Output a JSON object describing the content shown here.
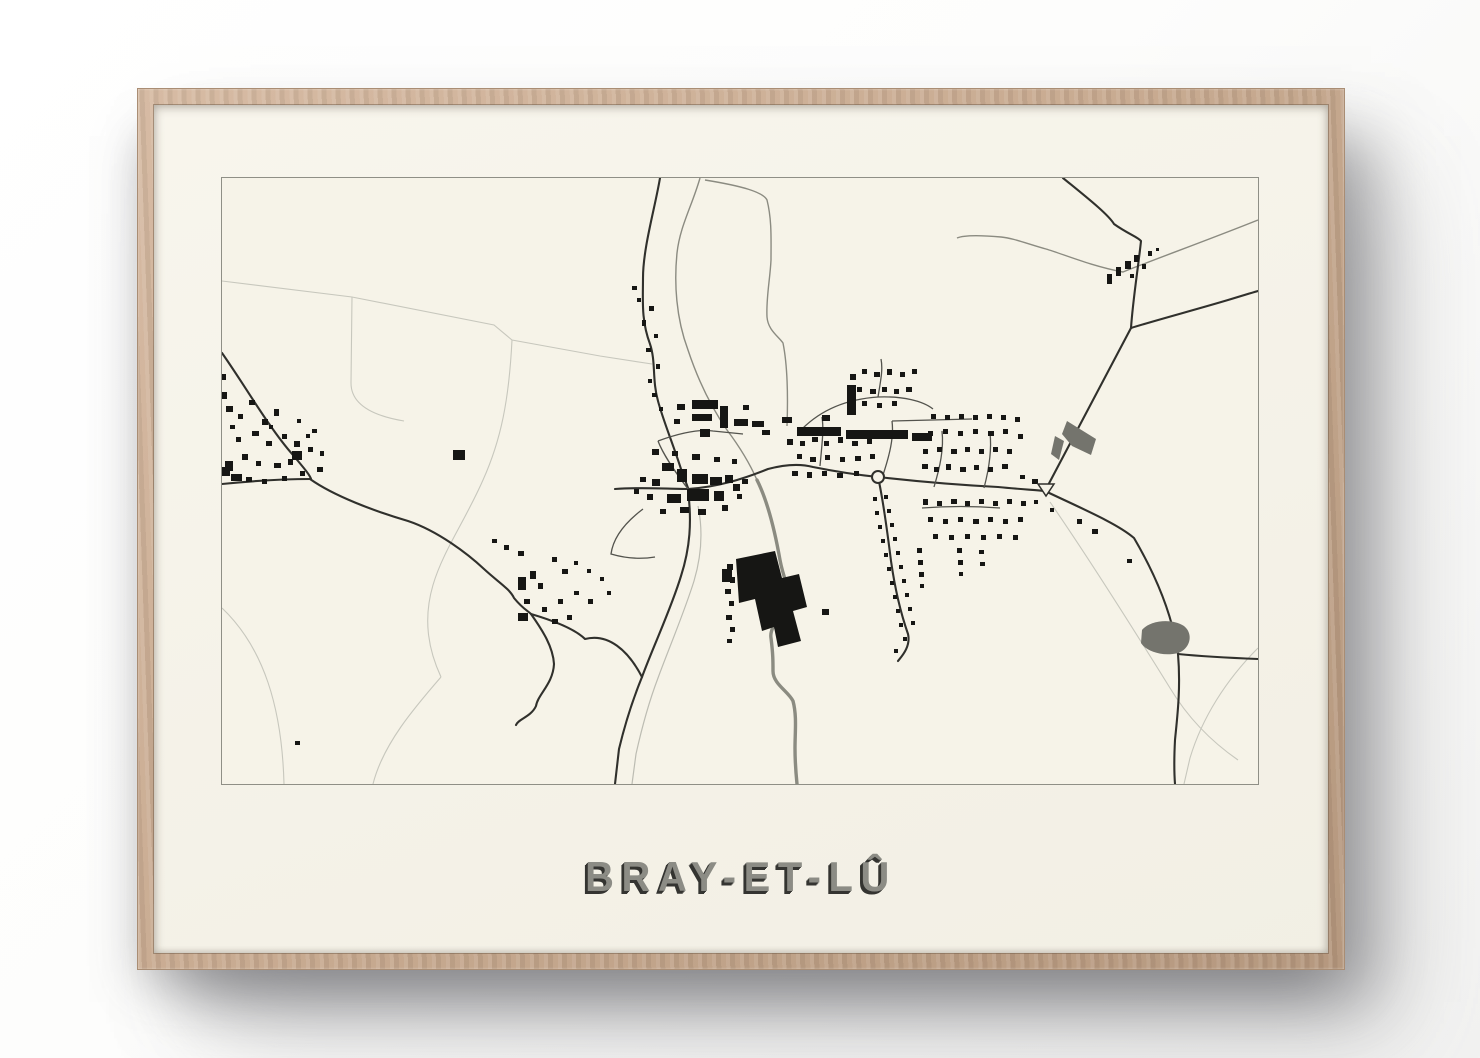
{
  "poster": {
    "title": "BRAY-ET-LÛ"
  },
  "colors": {
    "wall": "#fbfbfa",
    "frame_wood": "#c8aa90",
    "frame_edge": "#a98d74",
    "paper": "#f6f3e8",
    "map_border": "#8f8f86",
    "ink": "#161614",
    "road": "#30302c",
    "street": "#53534d",
    "water": "#8b8b81",
    "rail": "#bcbcb2",
    "field_line": "#c7c7bd",
    "pond": "#74746d",
    "title_face": "#8c8c85",
    "title_shadow": "#343431"
  }
}
